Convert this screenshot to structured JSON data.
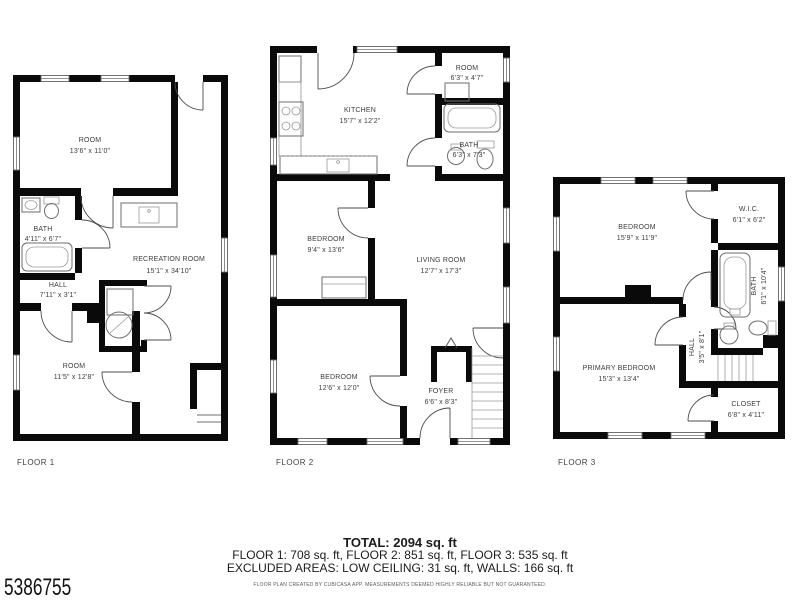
{
  "branding": {
    "listing_id": "5386755"
  },
  "summary": {
    "total": "TOTAL: 2094 sq. ft",
    "floor_totals": "FLOOR 1: 708 sq. ft, FLOOR 2: 851 sq. ft, FLOOR 3: 535 sq. ft",
    "excluded": "EXCLUDED AREAS: LOW CEILING: 31 sq. ft, WALLS: 166 sq. ft",
    "disclaimer": "FLOOR PLAN CREATED BY CUBICASA APP. MEASUREMENTS DEEMED HIGHLY RELIABLE BUT NOT GUARANTEED."
  },
  "floors": [
    {
      "label": "FLOOR 1",
      "rooms": [
        {
          "name": "ROOM",
          "dims": "13'6\" x 11'0\""
        },
        {
          "name": "BATH",
          "dims": "4'11\" x 6'7\""
        },
        {
          "name": "RECREATION ROOM",
          "dims": "15'1\" x 34'10\""
        },
        {
          "name": "HALL",
          "dims": "7'11\" x 3'1\""
        },
        {
          "name": "ROOM",
          "dims": "11'5\" x 12'8\""
        }
      ]
    },
    {
      "label": "FLOOR 2",
      "rooms": [
        {
          "name": "KITCHEN",
          "dims": "15'7\" x 12'2\""
        },
        {
          "name": "ROOM",
          "dims": "6'3\" x 4'7\""
        },
        {
          "name": "BATH",
          "dims": "6'3\" x 7'3\""
        },
        {
          "name": "BEDROOM",
          "dims": "9'4\" x 13'6\""
        },
        {
          "name": "LIVING ROOM",
          "dims": "12'7\" x 17'3\""
        },
        {
          "name": "BEDROOM",
          "dims": "12'6\" x 12'0\""
        },
        {
          "name": "FOYER",
          "dims": "6'6\" x 8'3\""
        }
      ]
    },
    {
      "label": "FLOOR 3",
      "rooms": [
        {
          "name": "BEDROOM",
          "dims": "15'9\" x 11'9\""
        },
        {
          "name": "W.I.C.",
          "dims": "6'1\" x 6'2\""
        },
        {
          "name": "BATH",
          "dims": "6'1\" x 10'4\""
        },
        {
          "name": "HALL",
          "dims": "3'5\" x 8'1\""
        },
        {
          "name": "PRIMARY BEDROOM",
          "dims": "15'3\" x 13'4\""
        },
        {
          "name": "CLOSET",
          "dims": "6'8\" x 4'11\""
        }
      ]
    }
  ],
  "colors": {
    "wall": "#0a0a0a",
    "label_text": "#3d3d3d",
    "fixture_line": "#6e6e6e"
  }
}
